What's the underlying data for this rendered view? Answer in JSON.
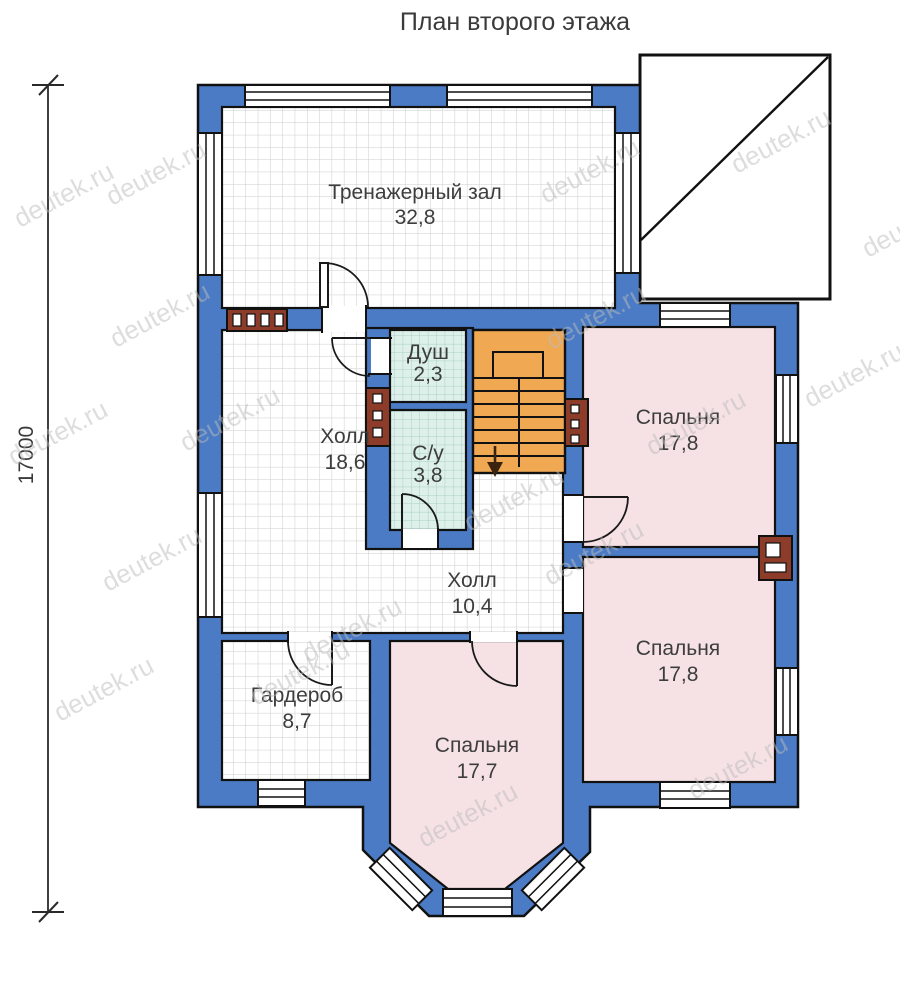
{
  "title": "План второго этажа",
  "dimension": {
    "value": "17000"
  },
  "watermark": {
    "text": "deutek.ru"
  },
  "colors": {
    "wall_blue": "#4a7bc4",
    "bedroom_pink": "#f6e2e4",
    "wet_room_mint": "#def0ea",
    "stairs_orange": "#f0a853",
    "vent_brown": "#8d3c2a",
    "outline_black": "#111111",
    "tile_line_gray": "#cdcdcd",
    "watermark_gray": "#bcbcbc"
  },
  "rooms": {
    "gym": {
      "name": "Тренажерный зал",
      "area": "32,8"
    },
    "hall1": {
      "name": "Холл",
      "area": "18,6"
    },
    "shower": {
      "name": "Душ",
      "area": "2,3"
    },
    "wc": {
      "name": "С/у",
      "area": "3,8"
    },
    "bedroom1": {
      "name": "Спальня",
      "area": "17,8"
    },
    "hall2": {
      "name": "Холл",
      "area": "10,4"
    },
    "bedroom2": {
      "name": "Спальня",
      "area": "17,8"
    },
    "wardrobe": {
      "name": "Гардероб",
      "area": "8,7"
    },
    "bedroom3": {
      "name": "Спальня",
      "area": "17,7"
    }
  }
}
